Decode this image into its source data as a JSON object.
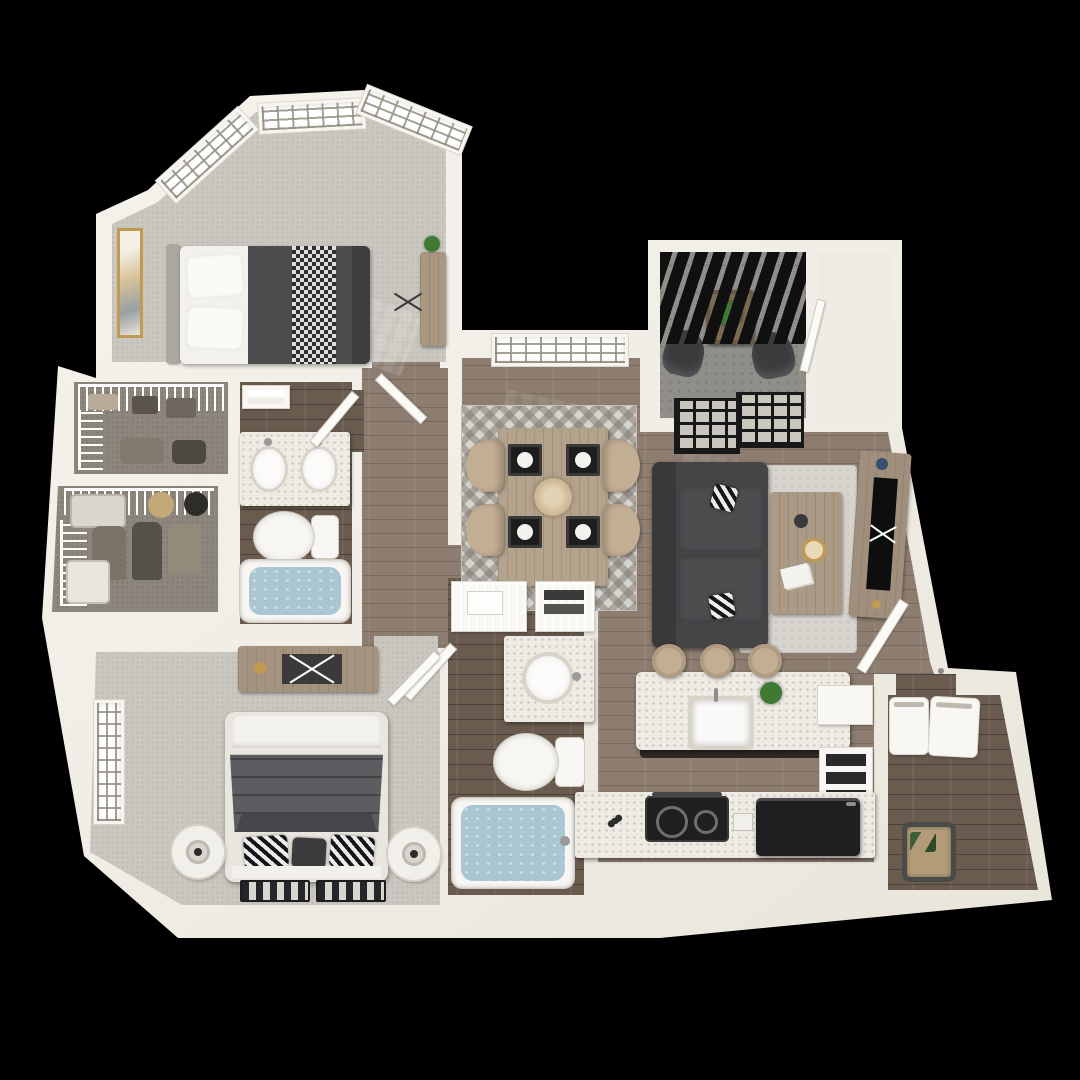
{
  "scene": {
    "title": "3D top-down apartment floor plan render on black background",
    "view": "dollhouse bird's-eye view, two-bedroom two-bath apartment",
    "rooms": [
      {
        "name": "bedroom-1",
        "position": "top-left",
        "furniture": [
          "bay-window-trio",
          "queen-bed-dark-duvet",
          "white-pillows",
          "gold-framed-wall-art",
          "dresser-with-plant",
          "ceiling-fan"
        ]
      },
      {
        "name": "walk-in-closet-a",
        "position": "left",
        "furniture": [
          "wire-shelving",
          "folded-clothes",
          "storage-bags"
        ]
      },
      {
        "name": "walk-in-closet-b",
        "position": "left",
        "furniture": [
          "wire-shelving",
          "hanging-clothes",
          "suitcase",
          "hat"
        ]
      },
      {
        "name": "bathroom-1",
        "position": "left-center",
        "furniture": [
          "double-sink-vanity",
          "toilet",
          "bathtub-with-water",
          "towel-shelf",
          "door"
        ]
      },
      {
        "name": "hallway",
        "position": "center-left",
        "furniture": [
          "doors"
        ]
      },
      {
        "name": "dining-room",
        "position": "center",
        "furniture": [
          "shuttered-window",
          "dining-table",
          "four-tub-chairs",
          "four-place-settings",
          "centerpiece",
          "chevron-rug"
        ]
      },
      {
        "name": "balcony",
        "position": "top-right",
        "furniture": [
          "pergola-slats",
          "two-outdoor-chairs",
          "side-table-with-plant",
          "storage-closet",
          "sliding-glass-door"
        ]
      },
      {
        "name": "living-room",
        "position": "right-center",
        "furniture": [
          "sofa-dark-gray",
          "two-accent-pillows",
          "area-rug",
          "coffee-table-with-decor",
          "media-console-tv",
          "entry-door"
        ]
      },
      {
        "name": "bathroom-2",
        "position": "bottom-center",
        "furniture": [
          "linen-wire-shelves",
          "towels",
          "vanity-round-sink",
          "toilet",
          "bathtub-with-water",
          "door"
        ]
      },
      {
        "name": "bedroom-2",
        "position": "bottom-left",
        "furniture": [
          "dresser-with-x-decor",
          "king-bed-striped-duvet",
          "patterned-pillows",
          "two-round-nightstands-with-lamps",
          "window",
          "two-runner-rugs"
        ]
      },
      {
        "name": "kitchen",
        "position": "bottom-right",
        "furniture": [
          "island-with-sink",
          "three-bar-stools",
          "potted-plant",
          "upper-cabinet",
          "open-shelf-unit",
          "cooktop",
          "refrigerator",
          "counter-run"
        ]
      },
      {
        "name": "laundry-room",
        "position": "bottom-right-corner",
        "furniture": [
          "washer",
          "dryer",
          "laundry-basket"
        ]
      }
    ]
  },
  "colors": {
    "background": "#000000",
    "wall": "#f1eee7",
    "carpet": "#cac7c0",
    "wood": "#8d7d70",
    "tile": "#6a5b4f",
    "concrete": "#908e89",
    "counter": "#edebe4",
    "water": "#a9c6d2",
    "sofa": "#454447",
    "bedding_dark": "#4c4c4f",
    "duvet": "#5d5c60",
    "tan": "#c2ae93",
    "woodfurn": "#a89781",
    "black_appliance": "#1f1f1f",
    "rug": "#d7d4ce",
    "gold": "#c09a4f",
    "plant": "#3f7a34",
    "door": "#fafaf7",
    "glass": "#c9c6be",
    "frame": "#181818",
    "slat": "#101010"
  }
}
